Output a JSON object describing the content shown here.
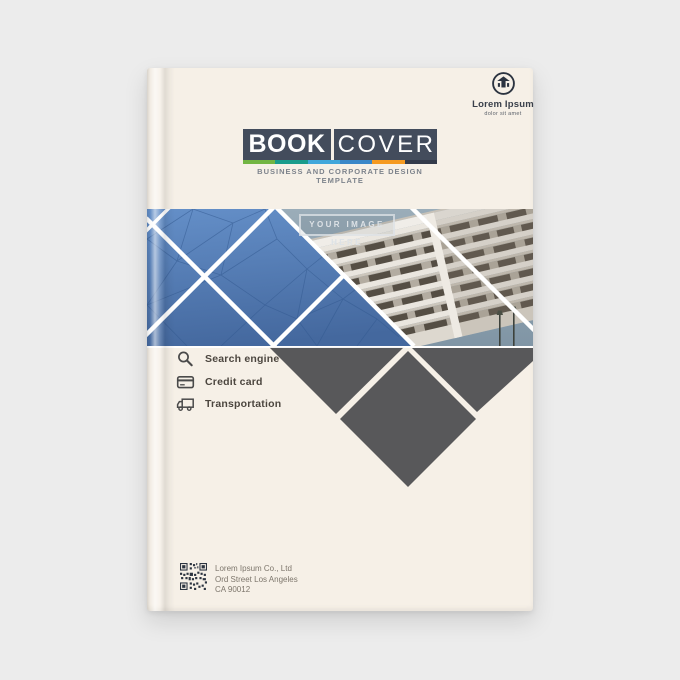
{
  "window": {
    "background": "#ececec"
  },
  "book": {
    "cover_color": "#f6f0e7"
  },
  "logo": {
    "name": "Lorem Ipsum",
    "tagline": "dolor sit amet",
    "color": "#2b3340"
  },
  "title": {
    "word_primary": "BOOK",
    "word_secondary": "COVER",
    "subtitle": "BUSINESS AND CORPORATE DESIGN TEMPLATE",
    "bar_color": "#434c5c",
    "stripe_colors": [
      "#72b543",
      "#1a9c8c",
      "#41a7db",
      "#3a87c8",
      "#f59a21",
      "#333a4a"
    ]
  },
  "hero": {
    "placeholder_label": "YOUR IMAGE HERE",
    "band_blue": "#4f7cb5",
    "shape_gray": "#58585a"
  },
  "features": [
    {
      "icon": "search-icon",
      "label": "Search engine"
    },
    {
      "icon": "credit-card-icon",
      "label": "Credit card"
    },
    {
      "icon": "truck-icon",
      "label": "Transportation"
    }
  ],
  "footer": {
    "company": "Lorem Ipsum Co., Ltd",
    "address_line1": "Ord Street Los Angeles",
    "address_line2": "CA 90012"
  }
}
